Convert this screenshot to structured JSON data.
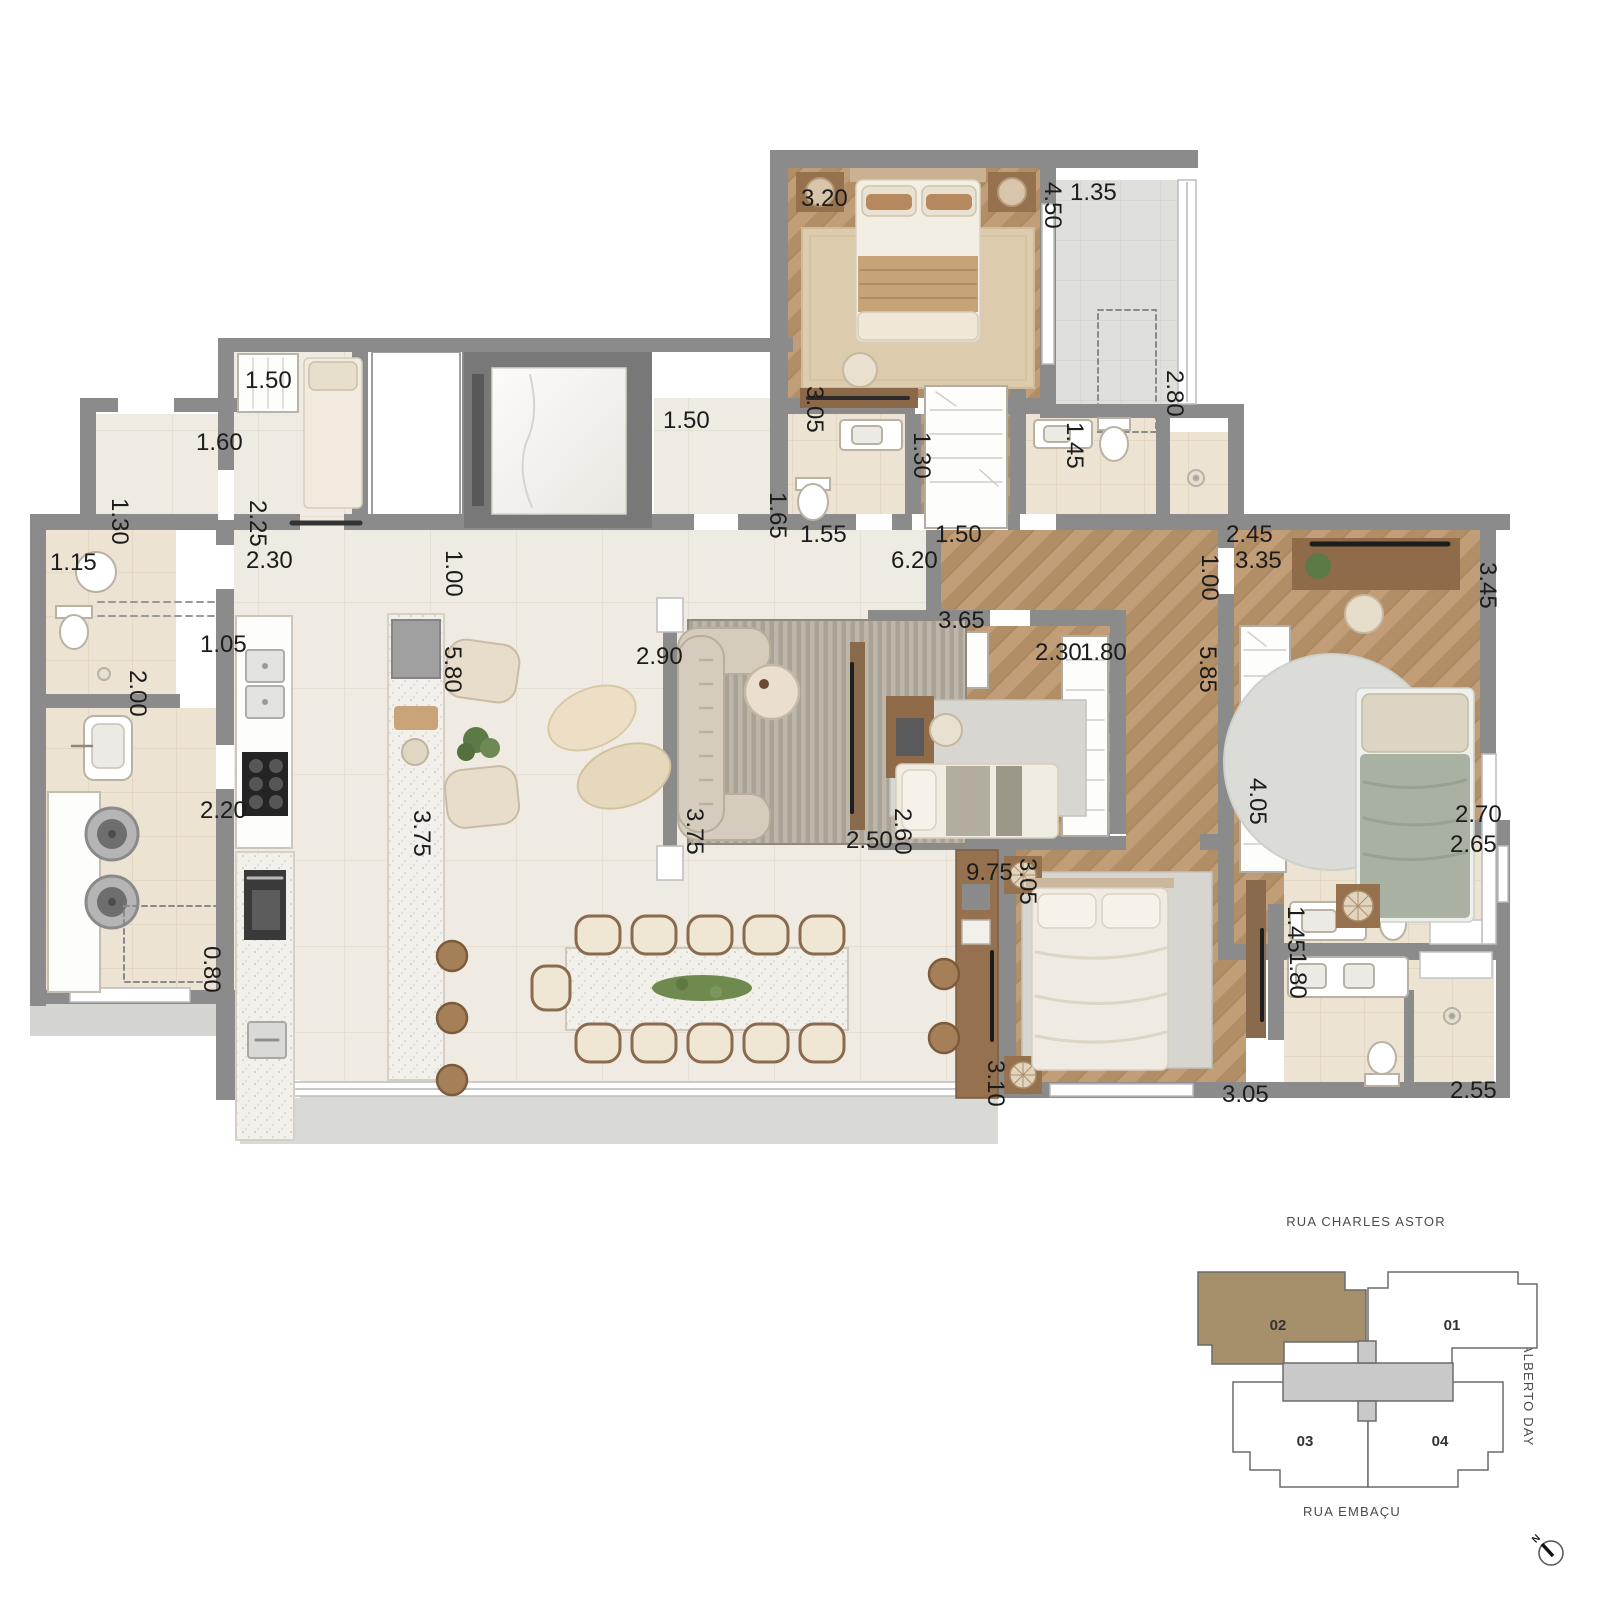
{
  "floor_plan": {
    "dimension_labels": [
      {
        "text": "3.20",
        "x": 801,
        "y": 206,
        "vertical": false
      },
      {
        "text": "4.50",
        "x": 1045,
        "y": 182,
        "vertical": true
      },
      {
        "text": "1.35",
        "x": 1070,
        "y": 200,
        "vertical": false
      },
      {
        "text": "2.80",
        "x": 1167,
        "y": 370,
        "vertical": true
      },
      {
        "text": "3.05",
        "x": 807,
        "y": 386,
        "vertical": true
      },
      {
        "text": "1.30",
        "x": 914,
        "y": 432,
        "vertical": true
      },
      {
        "text": "1.45",
        "x": 1067,
        "y": 422,
        "vertical": true
      },
      {
        "text": "1.55",
        "x": 800,
        "y": 542,
        "vertical": false
      },
      {
        "text": "1.50",
        "x": 935,
        "y": 542,
        "vertical": false
      },
      {
        "text": "2.45",
        "x": 1226,
        "y": 542,
        "vertical": false
      },
      {
        "text": "1.65",
        "x": 770,
        "y": 492,
        "vertical": true
      },
      {
        "text": "1.50",
        "x": 245,
        "y": 388,
        "vertical": false
      },
      {
        "text": "1.60",
        "x": 196,
        "y": 450,
        "vertical": false
      },
      {
        "text": "1.30",
        "x": 112,
        "y": 498,
        "vertical": true
      },
      {
        "text": "2.25",
        "x": 250,
        "y": 500,
        "vertical": true
      },
      {
        "text": "1.15",
        "x": 50,
        "y": 570,
        "vertical": false
      },
      {
        "text": "2.30",
        "x": 246,
        "y": 568,
        "vertical": false
      },
      {
        "text": "1.00",
        "x": 446,
        "y": 550,
        "vertical": true
      },
      {
        "text": "1.50",
        "x": 663,
        "y": 428,
        "vertical": false
      },
      {
        "text": "1.05",
        "x": 200,
        "y": 652,
        "vertical": false
      },
      {
        "text": "2.00",
        "x": 130,
        "y": 670,
        "vertical": true
      },
      {
        "text": "5.80",
        "x": 445,
        "y": 646,
        "vertical": true
      },
      {
        "text": "2.90",
        "x": 636,
        "y": 664,
        "vertical": false
      },
      {
        "text": "6.20",
        "x": 891,
        "y": 568,
        "vertical": false
      },
      {
        "text": "3.65",
        "x": 938,
        "y": 628,
        "vertical": false
      },
      {
        "text": "2.30",
        "x": 1035,
        "y": 660,
        "vertical": false
      },
      {
        "text": "1.80",
        "x": 1080,
        "y": 660,
        "vertical": false
      },
      {
        "text": "5.85",
        "x": 1200,
        "y": 646,
        "vertical": true
      },
      {
        "text": "1.00",
        "x": 1202,
        "y": 554,
        "vertical": true
      },
      {
        "text": "3.35",
        "x": 1235,
        "y": 568,
        "vertical": false
      },
      {
        "text": "3.45",
        "x": 1480,
        "y": 562,
        "vertical": true
      },
      {
        "text": "3.75",
        "x": 687,
        "y": 808,
        "vertical": true
      },
      {
        "text": "2.50",
        "x": 846,
        "y": 848,
        "vertical": false
      },
      {
        "text": "2.60",
        "x": 895,
        "y": 808,
        "vertical": true
      },
      {
        "text": "4.05",
        "x": 1250,
        "y": 778,
        "vertical": true
      },
      {
        "text": "2.70",
        "x": 1455,
        "y": 822,
        "vertical": false
      },
      {
        "text": "2.65",
        "x": 1450,
        "y": 852,
        "vertical": false
      },
      {
        "text": "9.75",
        "x": 966,
        "y": 880,
        "vertical": false
      },
      {
        "text": "3.05",
        "x": 1020,
        "y": 858,
        "vertical": true
      },
      {
        "text": "1.45",
        "x": 1288,
        "y": 906,
        "vertical": true
      },
      {
        "text": "1.80",
        "x": 1290,
        "y": 952,
        "vertical": true
      },
      {
        "text": "3.10",
        "x": 988,
        "y": 1060,
        "vertical": true
      },
      {
        "text": "3.05",
        "x": 1222,
        "y": 1102,
        "vertical": false
      },
      {
        "text": "2.55",
        "x": 1450,
        "y": 1098,
        "vertical": false
      },
      {
        "text": "2.20",
        "x": 200,
        "y": 818,
        "vertical": false
      },
      {
        "text": "3.75",
        "x": 414,
        "y": 810,
        "vertical": true
      },
      {
        "text": "0.80",
        "x": 204,
        "y": 946,
        "vertical": true
      }
    ]
  },
  "key_plan": {
    "streets": {
      "top": "RUA CHARLES ASTOR",
      "right": "RUA ALBERTO DAY",
      "bottom": "RUA EMBAÇU"
    },
    "units": [
      {
        "label": "01",
        "highlighted": false
      },
      {
        "label": "02",
        "highlighted": true
      },
      {
        "label": "03",
        "highlighted": false
      },
      {
        "label": "04",
        "highlighted": false
      }
    ],
    "highlight_color": "#a5906b",
    "compass_label": "N"
  },
  "palette": {
    "wall_gray": "#8b8b8b",
    "wood_floor": "#bf9e78",
    "cream_floor": "#f0ebe2",
    "bath_floor": "#ece3d2",
    "balcony_floor": "#dfdfdc"
  }
}
